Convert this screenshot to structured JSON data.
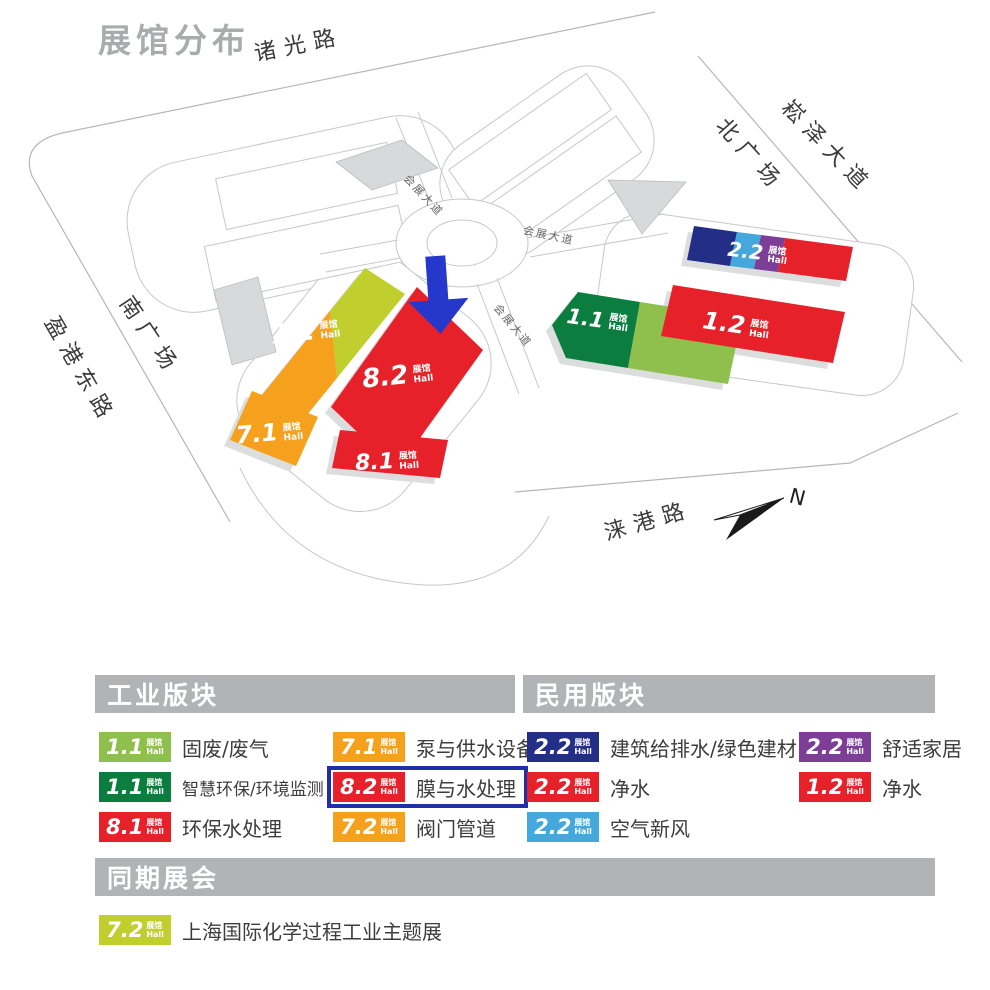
{
  "title": "展馆分布",
  "hall_unit": {
    "cn": "展馆",
    "en": "Hall"
  },
  "map": {
    "roads": {
      "zhuguang": "诸光路",
      "songze": "崧泽大道",
      "north_plaza": "北广场",
      "south_plaza": "南广场",
      "yinggang": "盈港东路",
      "laigang": "涞港路",
      "exhibition_ave": "会展大道"
    },
    "compass": "N",
    "halls": {
      "h72": "7.2",
      "h71": "7.1",
      "h82": "8.2",
      "h81": "8.1",
      "h11": "1.1",
      "h12": "1.2",
      "h22": "2.2"
    },
    "highlight_arrow_target": "8.2"
  },
  "colors": {
    "red": "#E62129",
    "orange": "#F5A11E",
    "yellow_green": "#C1CF2E",
    "light_green": "#8FBF4D",
    "dark_green": "#0B7E3F",
    "navy": "#232E87",
    "light_blue": "#45A8DC",
    "purple": "#7C3E96",
    "highlight_blue": "#1E2FA8",
    "arrow_blue": "#2638CC",
    "header_gray": "#B1B3B4",
    "title_gray": "#A9ABAD"
  },
  "legend": {
    "sections": [
      {
        "title": "工业版块",
        "items": [
          {
            "hall": "1.1",
            "color": "light_green",
            "label": "固废/废气",
            "highlight": false
          },
          {
            "hall": "1.1",
            "color": "dark_green",
            "label": "智慧环保/环境监测",
            "highlight": false
          },
          {
            "hall": "8.1",
            "color": "red",
            "label": "环保水处理",
            "highlight": false
          },
          {
            "hall": "7.1",
            "color": "orange",
            "label": "泵与供水设备",
            "highlight": false
          },
          {
            "hall": "8.2",
            "color": "red",
            "label": "膜与水处理",
            "highlight": true
          },
          {
            "hall": "7.2",
            "color": "orange",
            "label": "阀门管道",
            "highlight": false
          }
        ]
      },
      {
        "title": "民用版块",
        "items": [
          {
            "hall": "2.2",
            "color": "navy",
            "label": "建筑给排水/绿色建材",
            "highlight": false
          },
          {
            "hall": "2.2",
            "color": "red",
            "label": "净水",
            "highlight": false
          },
          {
            "hall": "2.2",
            "color": "light_blue",
            "label": "空气新风",
            "highlight": false
          },
          {
            "hall": "2.2",
            "color": "purple",
            "label": "舒适家居",
            "highlight": false
          },
          {
            "hall": "1.2",
            "color": "red",
            "label": "净水",
            "highlight": false
          }
        ]
      },
      {
        "title": "同期展会",
        "items": [
          {
            "hall": "7.2",
            "color": "yellow_green",
            "label": "上海国际化学过程工业主题展",
            "highlight": false
          }
        ]
      }
    ]
  }
}
